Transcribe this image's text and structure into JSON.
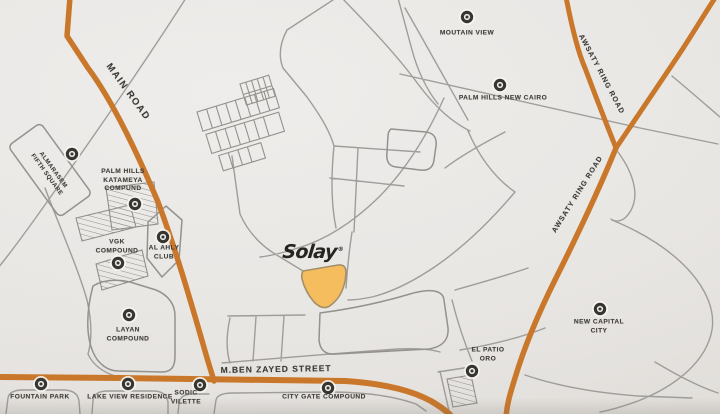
{
  "map": {
    "brand": {
      "logo_text": "Solay",
      "registered_mark": "®"
    },
    "roads": {
      "main_road": {
        "label": "MAIN ROAD"
      },
      "awsaty_ring_road_upper": {
        "label": "AWSATY RING ROAD"
      },
      "awsaty_ring_road_lower": {
        "label": "AWSATY RING ROAD"
      },
      "mben_zayed_street": {
        "label": "M.BEN ZAYED STREET"
      }
    },
    "places": [
      {
        "id": "moutain-view",
        "label": "MOUTAIN VIEW"
      },
      {
        "id": "palm-hills-new-cairo",
        "label": "PALM HILLS NEW CAIRO"
      },
      {
        "id": "almarasem-fifth-square",
        "label": "ALMARASEM\nFIFTH SQUARE"
      },
      {
        "id": "palm-hills-katameya-compound",
        "label": "PALM HILLS\nKATAMEYA\nCOMPUND"
      },
      {
        "id": "vgk-compound",
        "label": "VGK\nCOMPOUND"
      },
      {
        "id": "al-ahly-club",
        "label": "AL AHLY\nCLUB"
      },
      {
        "id": "layan-compound",
        "label": "LAYAN\nCOMPOUND"
      },
      {
        "id": "fountain-park",
        "label": "FOUNTAIN PARK"
      },
      {
        "id": "lake-view-residence",
        "label": "LAKE VIEW RESIDENCE"
      },
      {
        "id": "sodic-vilette",
        "label": "SODIC\nVILETTE"
      },
      {
        "id": "city-gate-compound",
        "label": "CITY GATE COMPOUND"
      },
      {
        "id": "el-patio-oro",
        "label": "EL PATIO\nORO"
      },
      {
        "id": "new-capital-city",
        "label": "NEW CAPITAL\nCITY"
      }
    ],
    "colors": {
      "background": "#e9e7e4",
      "highlight_road": "#c9782b",
      "plot_fill": "#f6bd5e",
      "minor_road": "#9e9d99",
      "label_text": "#3c3a35"
    }
  }
}
